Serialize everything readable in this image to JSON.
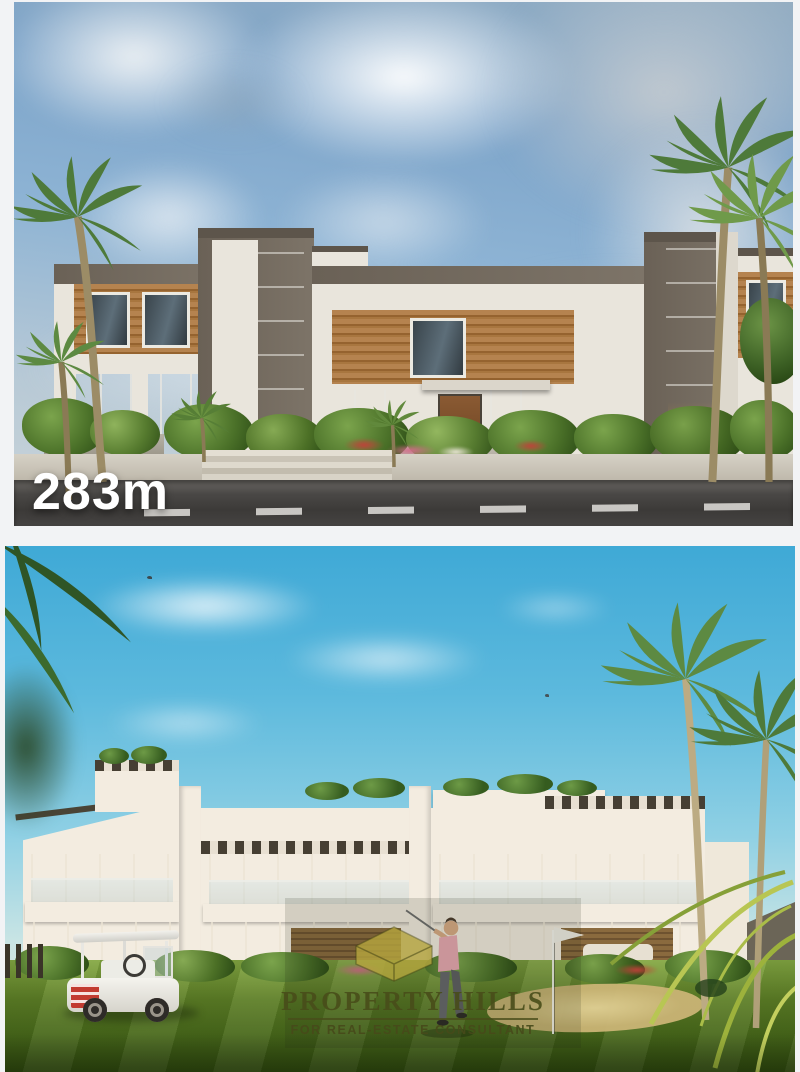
{
  "page": {
    "background": "#f2f3f5",
    "description": "Two stacked architectural renderings of a residential villa compound"
  },
  "top_photo": {
    "area_label": "283m",
    "label_color": "#ffffff",
    "scene": "Modern two-storey townhouses with grey concrete towers, wood slat facades, palm trees, landscaped frontage and asphalt road",
    "colors": {
      "sky": "#7da4c9",
      "clouds": "#e8eaec",
      "wall": "#e9e5dc",
      "concrete": "#797065",
      "wood": "#a9773f",
      "glass": "#39444b",
      "road": "#3f3d3b",
      "sidewalk": "#c6c0b4",
      "foliage": "#4e7a3a"
    }
  },
  "bottom_photo": {
    "watermark": {
      "brand": "PROPERTY HILLS",
      "tagline": "FOR REAL-ESTATE CONSULTANT",
      "icon": "house-icon",
      "text_color": "#4a4f1e",
      "icon_color": "#b6a63e"
    },
    "scene": "White modern villas on a golf lawn with a golfer, golf cart, sand bunker, flag and palm trees",
    "colors": {
      "sky": "#4fb2d8",
      "wall": "#f3ece0",
      "glass": "#2c3833",
      "lawn": "#55761f",
      "sand": "#dcc98e",
      "cart_sign": "#c23b31",
      "golfer_shirt": "#e8a9b2"
    }
  }
}
